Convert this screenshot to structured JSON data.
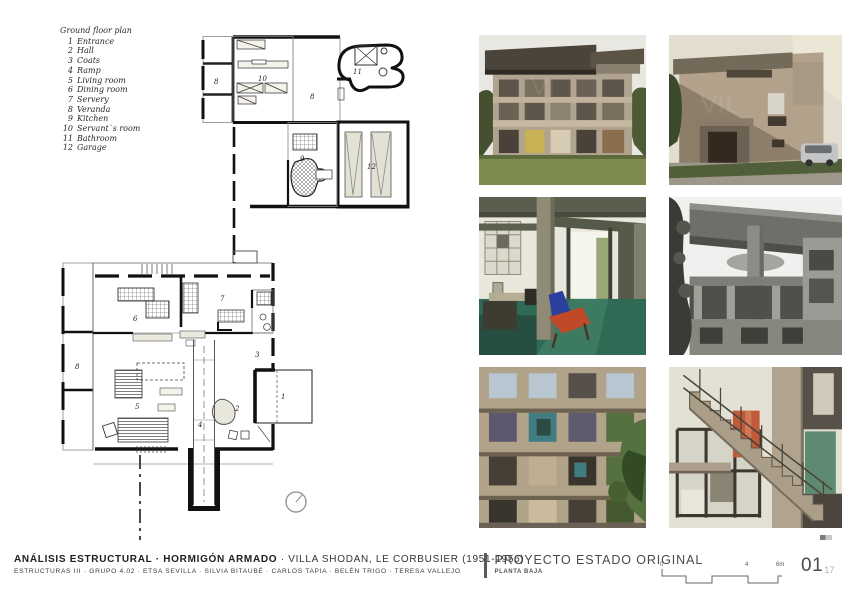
{
  "legend": {
    "title": "Ground floor plan",
    "items": [
      {
        "num": "1",
        "label": "Entrance"
      },
      {
        "num": "2",
        "label": "Hall"
      },
      {
        "num": "3",
        "label": "Coats"
      },
      {
        "num": "4",
        "label": "Ramp"
      },
      {
        "num": "5",
        "label": "Living room"
      },
      {
        "num": "6",
        "label": "Dining room"
      },
      {
        "num": "7",
        "label": "Servery"
      },
      {
        "num": "8",
        "label": "Veranda"
      },
      {
        "num": "9",
        "label": "Kitchen"
      },
      {
        "num": "10",
        "label": "Servant`s room"
      },
      {
        "num": "11",
        "label": "Bathroom"
      },
      {
        "num": "12",
        "label": "Garage"
      }
    ]
  },
  "plan": {
    "labels": {
      "veranda_top": "8",
      "servants_room": "10",
      "bathroom": "11",
      "veranda_mid": "8",
      "kitchen": "9",
      "garage": "12",
      "dining": "6",
      "servery": "7",
      "veranda_main": "8",
      "living": "5",
      "coats": "3",
      "hall": "2",
      "entrance": "1",
      "ramp": "4"
    }
  },
  "footer": {
    "title_bold": "ANÁLISIS ESTRUCTURAL · HORMIGÓN ARMADO",
    "title_rest": "· VILLA SHODAN, LE CORBUSIER (1951-1956)",
    "credits": "ESTRUCTURAS III · GRUPO 4.02 · ETSA SEVILLA · SILVIA BITAUBÉ · CARLOS TAPIA · BELÉN TRIGO · TERESA VALLEJO",
    "project_title": "PROYECTO ESTADO ORIGINAL",
    "project_subtitle": "PLANTA BAJA",
    "scale": {
      "t0": "0",
      "t4": "4",
      "t6": "6m"
    },
    "page_number": "01",
    "page_total": "17"
  },
  "palette": {
    "wall_ink": "#111111",
    "concrete": "#b1a28a",
    "roof_dark": "#4a443a",
    "lawn_green": "#7d8a50",
    "floor_green": "#2f6a54",
    "chair_red": "#c04a28",
    "panel_red": "#c05a39",
    "door_green": "#5d8a71",
    "sky_blue": "#b7c6d0"
  }
}
